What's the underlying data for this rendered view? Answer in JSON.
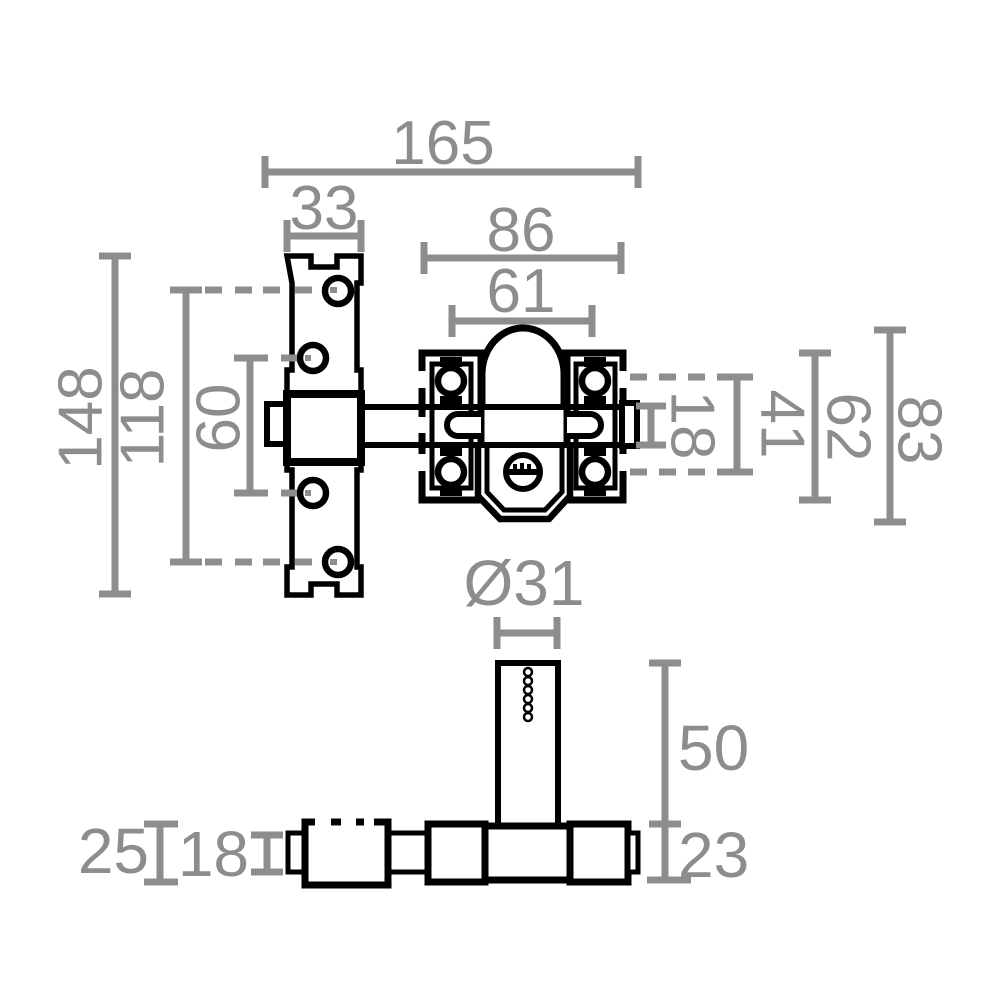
{
  "drawing": {
    "kind": "technical dimension drawing",
    "subject": "door bolt rim lock, two orthographic views",
    "colors": {
      "outline": "#000000",
      "dimension": "#8d8d8d",
      "background": "#ffffff"
    },
    "views": {
      "front": {
        "dimensions": {
          "total_length": "165",
          "keeper_width": "33",
          "body_width": "86",
          "screw_spacing": "61",
          "keeper_height": "148",
          "outer_hole_spacing": "118",
          "inner_hole_spacing": "60",
          "bolt_height": "18",
          "plate_opening": "41",
          "body_height": "62",
          "overall_height": "83"
        }
      },
      "bottom": {
        "dimensions": {
          "cylinder_diameter": "Ø31",
          "cylinder_height": "50",
          "body_depth": "23",
          "keeper_depth": "25",
          "bolt_depth": "18"
        }
      }
    }
  }
}
